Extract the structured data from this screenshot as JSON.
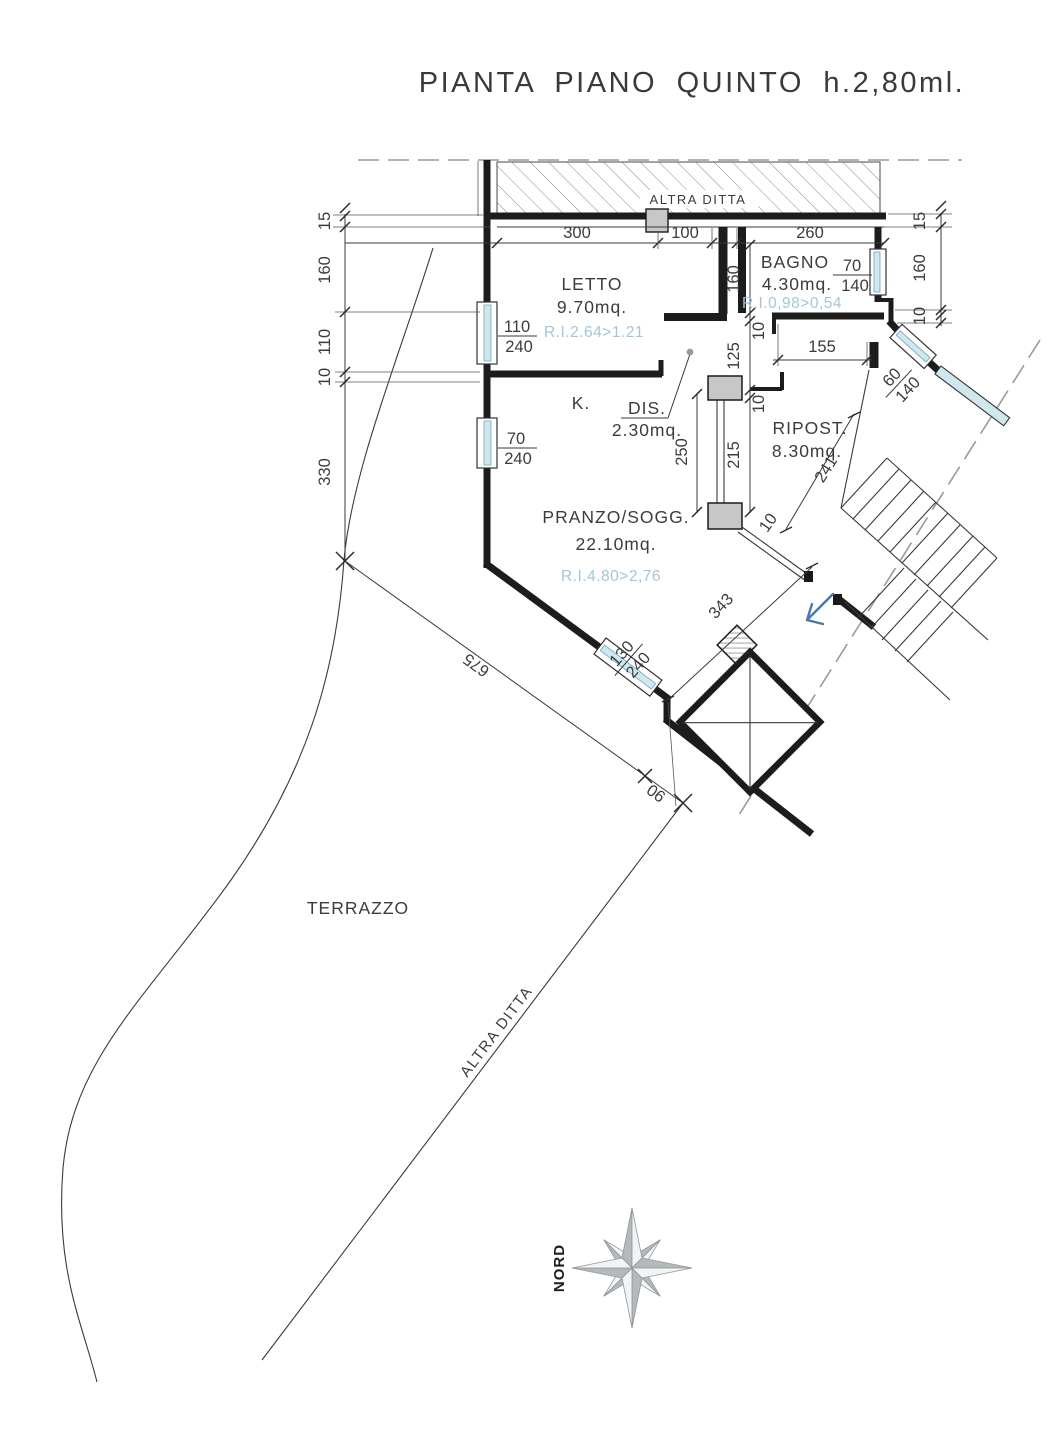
{
  "title": "PIANTA PIANO QUINTO h.2,80ml.",
  "boundaries": {
    "top_label": "ALTRA DITTA",
    "diagonal_label": "ALTRA DITTA"
  },
  "rooms": {
    "letto": {
      "name": "LETTO",
      "area": "9.70mq.",
      "ri": "R.I.2.64>1.21"
    },
    "bagno": {
      "name": "BAGNO",
      "area": "4.30mq.",
      "ri": "R.I.0,98>0,54"
    },
    "dis": {
      "name": "DIS.",
      "area": "2.30mq."
    },
    "ripost": {
      "name": "RIPOST.",
      "area": "8.30mq."
    },
    "pranzo": {
      "name": "PRANZO/SOGG.",
      "area": "22.10mq.",
      "ri": "R.I.4.80>2,76"
    },
    "kitchen": {
      "name": "K."
    },
    "terrazzo": {
      "name": "TERRAZZO"
    }
  },
  "compass": {
    "label": "NORD"
  },
  "dims": {
    "top300": "300",
    "top100": "100",
    "top260": "260",
    "L15": "15",
    "L160": "160",
    "L110": "110",
    "L10": "10",
    "L330": "330",
    "R15": "15",
    "R160": "160",
    "R10": "10",
    "M160": "160",
    "M10a": "10",
    "M125": "125",
    "M10b": "10",
    "M215": "215",
    "M250": "250",
    "M155": "155",
    "D241": "241",
    "D343": "343",
    "D675": "675",
    "D90": "90",
    "D10": "10",
    "W1n": "110",
    "W1d": "240",
    "W2n": "70",
    "W2d": "240",
    "W3n": "70",
    "W3d": "140",
    "W4n": "60",
    "W4d": "140",
    "W5n": "130",
    "W5d": "240"
  },
  "colors": {
    "glazing": "#cfe7ed",
    "ri_text": "#a5c6d8",
    "entrance_arrow": "#4878ad",
    "compass_gray": "#b4b9bc",
    "pillar_gray": "#c7c7c7"
  }
}
